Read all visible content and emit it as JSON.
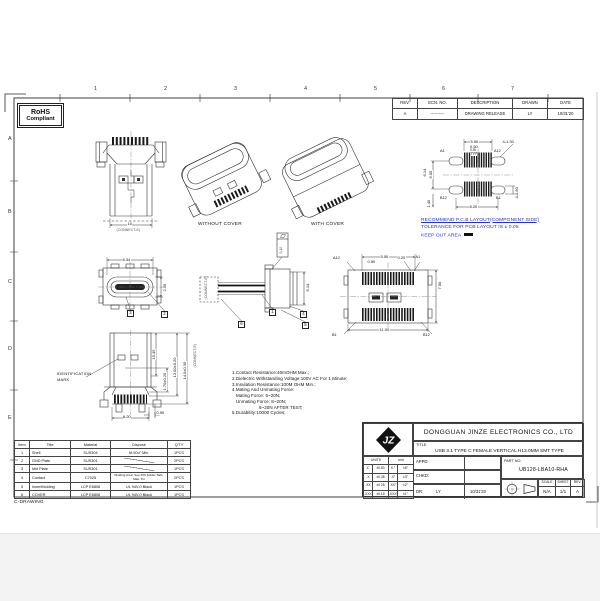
{
  "sheet": {
    "grid_cols": [
      "1",
      "2",
      "3",
      "4",
      "5",
      "6",
      "7"
    ],
    "grid_rows": [
      "A",
      "B",
      "C",
      "D",
      "E"
    ],
    "footer": "C-DRAWING"
  },
  "stamp": {
    "line1": "RoHS",
    "line2": "Compliant"
  },
  "rev_table": {
    "headers": [
      "REV.",
      "ECN. NO.",
      "DESCRIPTION",
      "DRAWN",
      "DATE"
    ],
    "row": {
      "rev": "A",
      "ecn": "----------",
      "description": "DRAWING RELEASE",
      "drawn": "LY",
      "date": "10/31'20"
    }
  },
  "views": {
    "front_top": {
      "dim_width": "10",
      "ref": "(CONNECT-E)"
    },
    "iso_without_cover": {
      "label": "WITHOUT COVER"
    },
    "iso_with_cover": {
      "label": "WITH COVER"
    },
    "pcb_layout": {
      "dims": {
        "pad_span": "5.50",
        "pad_offset": "0.50",
        "pad_width": "0.30",
        "pad_width_qual": "TYP",
        "corner_holes": "4-1.30",
        "row_pitch_outer": "6.14",
        "row_pitch_inner": "6.00",
        "corner_pad": "4-0.80",
        "edge_offset": "1.40",
        "hole_span": "8.20"
      },
      "pins": {
        "a_first": "A1",
        "a_last": "A12",
        "b_last": "B12",
        "b_first": "B1"
      }
    },
    "top": {
      "dims": {
        "width": "8.34",
        "depth": "2.56"
      },
      "balloons": [
        "3",
        "2"
      ]
    },
    "side": {
      "dims": {
        "height": "6.14",
        "flatness": "0.10"
      },
      "balloons": [
        "1",
        "4",
        "5",
        "6"
      ],
      "ref": "(CONNECT-E)"
    },
    "bottom": {
      "dims": {
        "pad_span": "5.50",
        "pad_offset": "0.50",
        "pad_width": "0.20",
        "depth": "7.00",
        "width": "11.00"
      },
      "pins": {
        "a_last": "A12",
        "a_first": "A1",
        "b_first": "B1",
        "b_last": "B12"
      }
    },
    "front_bottom": {
      "dims": {
        "d1": "15.45",
        "d2": "1.70±0.20",
        "d3": "13.00±0.20",
        "d4": "14.0±0.30",
        "d5": "8.20",
        "d6": "0.90"
      },
      "id_mark_label_1": "IDENTIFICATION",
      "id_mark_label_2": "MARK",
      "ref": "(CONNECT-E)"
    }
  },
  "notes": {
    "lines": [
      "1.Contact Resistance:40mOHM Max.;",
      "2.Dielectric Withstanding Voltage:100V AC For 1 Minute;",
      "3.Insulation Resistance:100M OHM Min.;",
      "4.Mating And Unmating Force:",
      "Mating Force: 5~20N;",
      "Unmating Force: 8~20N;",
      "6~20N AFTER TEST;",
      "5.Durability:10000 Cycles;"
    ]
  },
  "pcb_note": {
    "line1": "RECOMMEND P.C.B LAYOUT(COMPONENT SIDE)",
    "line2": "TOLERANCE FOR PCB LAYOUT IS ± 0.05",
    "line3": "KEEP OUT AREA"
  },
  "parts_table": {
    "headers": [
      "Item",
      "Title",
      "Material",
      "Dispose",
      "Q'TY"
    ],
    "rows": [
      [
        "1",
        "Shell",
        "SUS304",
        "Ni.50u\" Min.",
        "1PCS"
      ],
      [
        "2",
        "GND Plate",
        "SUS301",
        "",
        "2PCS"
      ],
      [
        "3",
        "Mid Plate",
        "SUS301",
        "",
        "1PCS"
      ],
      [
        "4",
        "Contact",
        "C7025",
        "Molding Area: See P/N Solder Tails: Matt. Tin",
        "2PCS"
      ],
      [
        "5",
        "InsertMolding",
        "LCP E6808",
        "UL 94V-0 Black",
        "1PCS"
      ],
      [
        "6",
        "COVER",
        "LCP E6808",
        "UL 94V-0 Black",
        "1PCS"
      ]
    ]
  },
  "title_block": {
    "company": "DONGGUAN JINZE ELECTRONICS CO., LTD",
    "title_label": "TITLE:",
    "title": "USB 3.1 TYPE C FEMALE VERTICAL H13.0MM SMT TYPE",
    "units_label": "UNITS",
    "units_value": "mm",
    "tolerances": [
      [
        "X.",
        "±0.50",
        "X.°",
        "±5°"
      ],
      [
        ".X",
        "±0.38",
        ".X°",
        "±3°"
      ],
      [
        ".XX",
        "±0.25",
        ".XX°",
        "±2°"
      ],
      [
        ".XXX",
        "±0.15",
        ".XXX°",
        "±1°"
      ]
    ],
    "appd_label": "APPD:",
    "chkd_label": "CHKD:",
    "dr_label": "DR:",
    "dr_name": "LY",
    "dr_date": "10/31'20",
    "part_no_label": "PART NO.",
    "part_no": "UB128-LBA10-RHA",
    "scale_label": "SCALE",
    "scale": "N/A",
    "sheet_label": "SHEET",
    "sheet": "1/1",
    "rev_label": "REV.",
    "rev": "A",
    "logo_text": "JZ"
  }
}
